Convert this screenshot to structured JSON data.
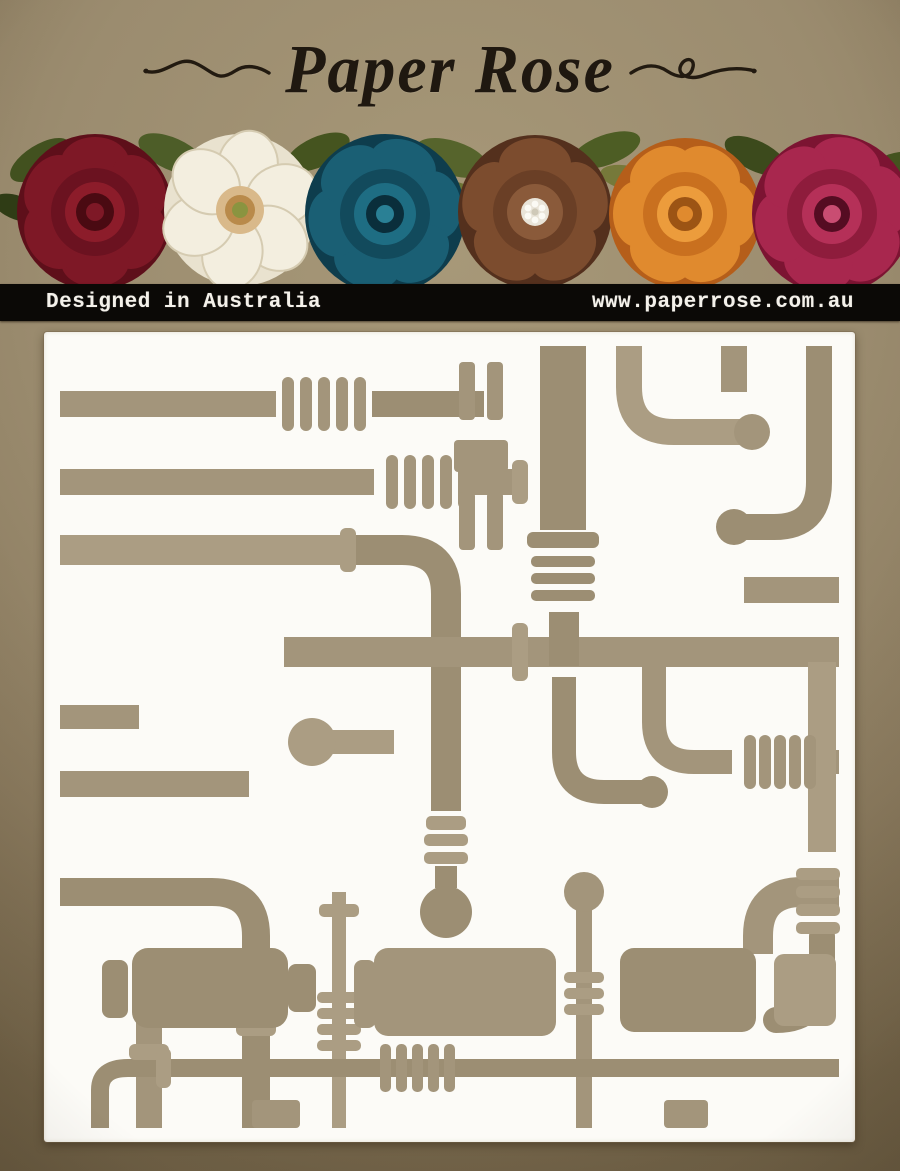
{
  "brand": {
    "title": "Paper Rose"
  },
  "info_bar": {
    "left_text": "Designed in Australia",
    "right_text": "www.paperrose.com.au"
  },
  "banner": {
    "flowers": [
      "dark-red-rose",
      "white-magnolia",
      "teal-rose",
      "bronze-flower-with-gem",
      "orange-rose",
      "magenta-peony"
    ]
  },
  "colors": {
    "kraft_background": "#9b8c6f",
    "info_bar_background": "#0b0906",
    "info_bar_text": "#f4f1ea",
    "title_text": "#1f1810",
    "stencil_panel": "#fcfbf7",
    "pipe_cutout": "#a3957b"
  }
}
